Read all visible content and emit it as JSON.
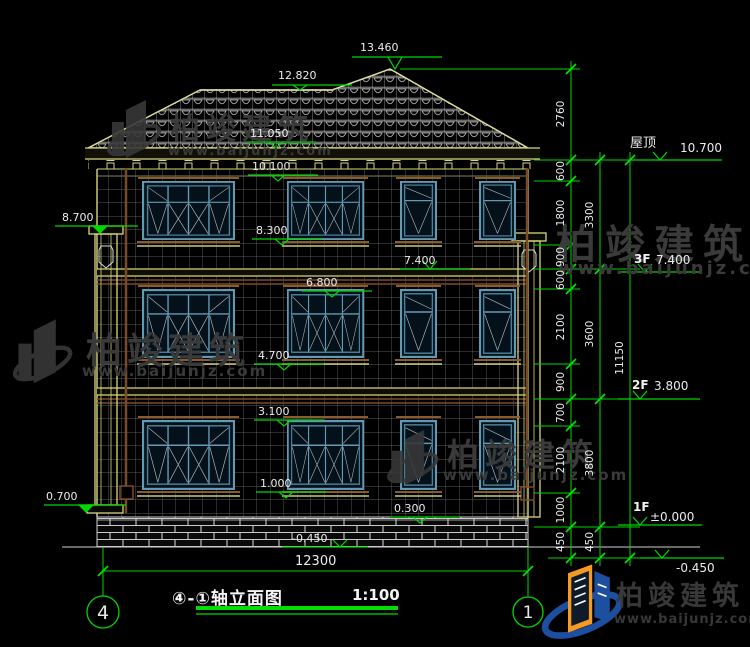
{
  "drawing": {
    "title": "④-①轴立面图",
    "scale": "1:100",
    "axis_left": "4",
    "axis_right": "1",
    "floor_levels": {
      "roof": {
        "name": "屋顶",
        "elev": "10.700"
      },
      "f3": {
        "name": "3F",
        "elev": "7.400"
      },
      "f2": {
        "name": "2F",
        "elev": "3.800"
      },
      "f1": {
        "name": "1F",
        "elev": "±0.000"
      },
      "grade": {
        "elev": "-0.450"
      }
    },
    "facade_elevations": [
      "13.460",
      "12.820",
      "11.050",
      "10.100",
      "8.300",
      "7.400",
      "6.800",
      "4.700",
      "3.100",
      "1.000",
      "0.300",
      "-0.450"
    ],
    "left_elevations": [
      "8.700",
      "0.700"
    ],
    "dim_chain_inner": [
      "2760",
      "600",
      "1800",
      "900",
      "600",
      "2100",
      "900",
      "700",
      "2100",
      "1000",
      "450"
    ],
    "dim_chain_mid": [
      "3300",
      "3600",
      "3800",
      "450"
    ],
    "dim_total": "11150",
    "dim_width": "12300"
  },
  "watermark": {
    "brand": "柏竣建筑",
    "url": "www.baijunjz.com"
  },
  "logo": {
    "brand": "柏竣建筑",
    "url": "www.baijunjz.com"
  },
  "colors": {
    "background": "#000000",
    "line_green": "#00d800",
    "cad_yellow": "#d6d67e",
    "window_teal": "#639ab3",
    "tile_gray": "#b0b0b0",
    "brown": "#7a4a28",
    "dim_text": "#ececec",
    "watermark_gray": "#3a3a3a",
    "logo_orange": "#f59a23",
    "logo_blue": "#1d4fa0"
  }
}
